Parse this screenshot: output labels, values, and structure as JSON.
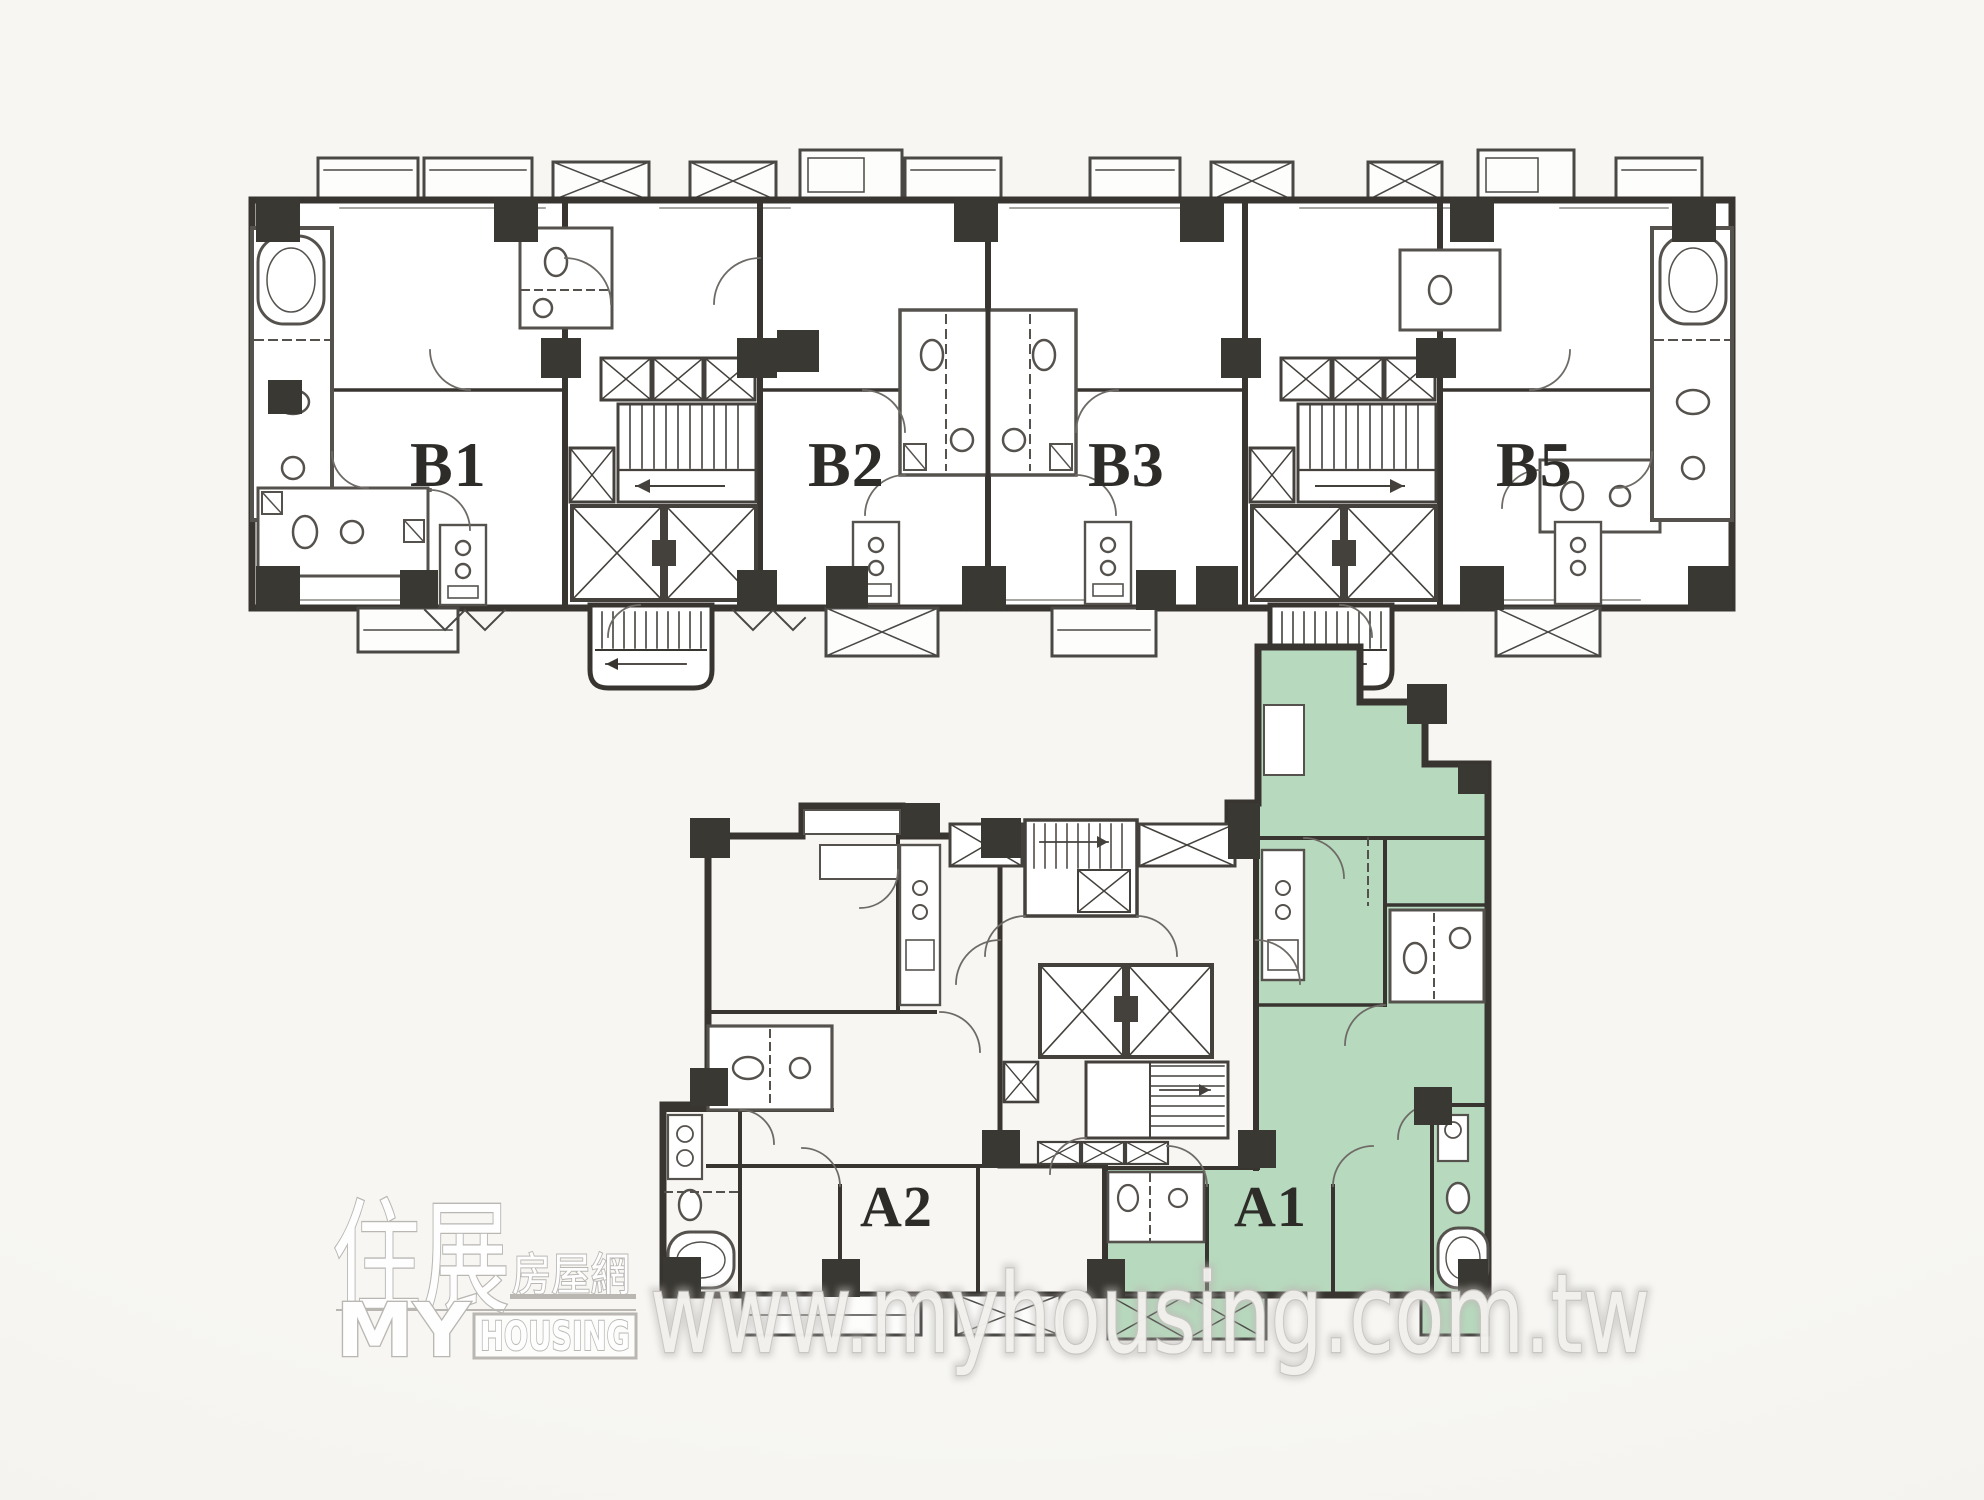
{
  "page": {
    "background_color": "#f7f6f3",
    "description_kind": "apartment floor plan scan"
  },
  "floor_plan": {
    "highlight_color": "#b7d9bd",
    "wall_color": "#383531",
    "upper_building": {
      "units": [
        {
          "label": "B1"
        },
        {
          "label": "B2"
        },
        {
          "label": "B3"
        },
        {
          "label": "B5"
        }
      ]
    },
    "lower_building": {
      "units": [
        {
          "label": "A2"
        },
        {
          "label": "A1"
        }
      ],
      "highlighted_unit": "A1"
    }
  },
  "branding": {
    "logo": {
      "chinese_main": "住展",
      "chinese_sub": "房屋網",
      "english_line1": "MY",
      "english_line2": "HOUSING"
    },
    "watermark_url": "www.myhousing.com.tw"
  }
}
